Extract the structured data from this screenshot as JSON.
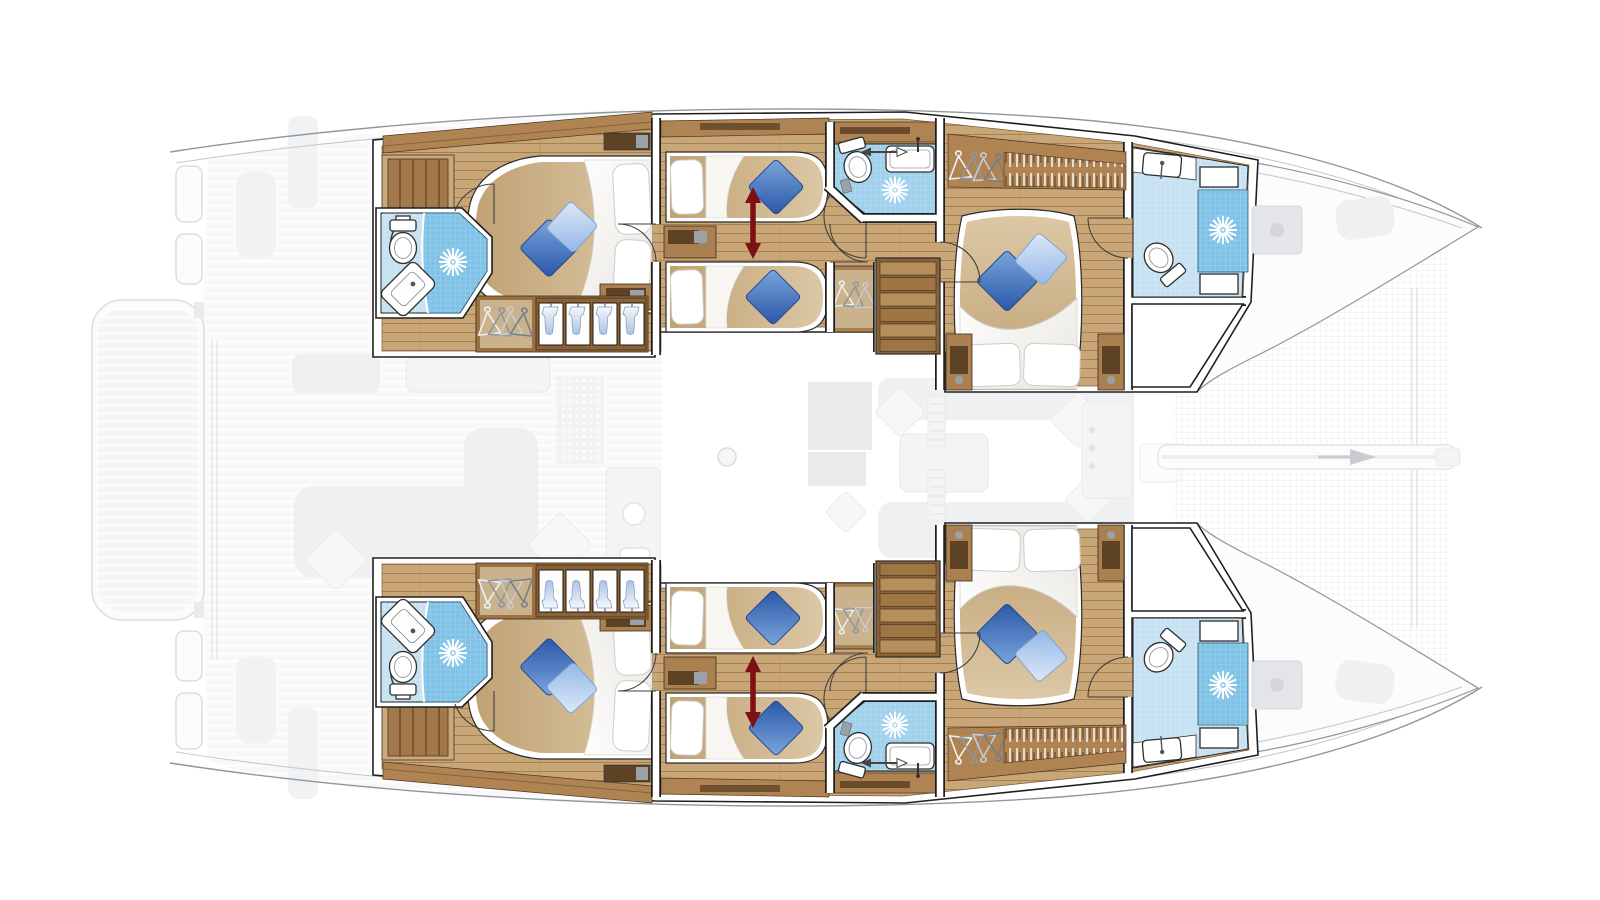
{
  "figure": {
    "type": "yacht-deck-plan",
    "vessel": "catamaran",
    "view": "top-down-floor-plan",
    "bow_direction": "right",
    "highlighted_content": "hull cabins lower deck",
    "ghosted_content": "main deck saloon, cockpit, swim platform, trampoline"
  },
  "counts": {
    "double_bed_cabins": 4,
    "convertible_twin_cabins": 2,
    "bathrooms_with_shower": 6,
    "staircases": 2,
    "bed_conversion_arrows": 2
  },
  "palette": {
    "background": "#ffffff",
    "hull_line": "#90979c",
    "hull_line_soft": "#c6cacd",
    "ghost_fill": "#f1f2f4",
    "ghost_line": "#e2e5e8",
    "wall_line": "#1f1f1f",
    "wood_floor": "#c9a678",
    "wood_plank_line": "#a87f4f",
    "wood_furniture": "#ab8050",
    "wood_furniture_dark": "#5e4226",
    "wood_shelf": "#b08352",
    "stair_light": "#b68f5c",
    "stair_dark": "#9d7243",
    "mattress_light": "#dcc8a6",
    "mattress_dark": "#c0a274",
    "bedding": "#ffffff",
    "bedding_shadow": "#e8e5de",
    "pillow_dark_1": "#7aa6dc",
    "pillow_dark_2": "#2a56a8",
    "pillow_light_1": "#dde9f8",
    "pillow_light_2": "#93b7e6",
    "tile": "#c6e1f2",
    "shower": "#7fc2e6",
    "shower_mid": "#9fd0ec",
    "towel_1": "#f4f8fc",
    "towel_2": "#a9c2e2",
    "arrow_red": "#7c1113",
    "trampoline_line": "#e6e9ec"
  },
  "icons": [
    "shower-sunburst-icon",
    "toilet-icon",
    "sink-icon",
    "hanger-icon",
    "towel-shelf-icon",
    "door-swing-icon",
    "stairs-icon",
    "bed-convert-arrow-icon",
    "bowsprit-arrow-icon",
    "mast-foot-icon"
  ],
  "regions": {
    "port_hull": [
      "aft-owner-cabin",
      "aft-bathroom",
      "convertible-twin-cabin",
      "midship-bathroom",
      "staircase",
      "forward-cabin",
      "forward-bathroom",
      "bow-storage"
    ],
    "starboard_hull": [
      "aft-owner-cabin",
      "aft-bathroom",
      "convertible-twin-cabin",
      "midship-bathroom",
      "staircase",
      "forward-cabin",
      "forward-bathroom",
      "bow-storage"
    ],
    "center": [
      "saloon-ghost",
      "galley-ghost",
      "cockpit-ghost",
      "swim-platform-ghost",
      "trampoline",
      "bowsprit"
    ]
  }
}
